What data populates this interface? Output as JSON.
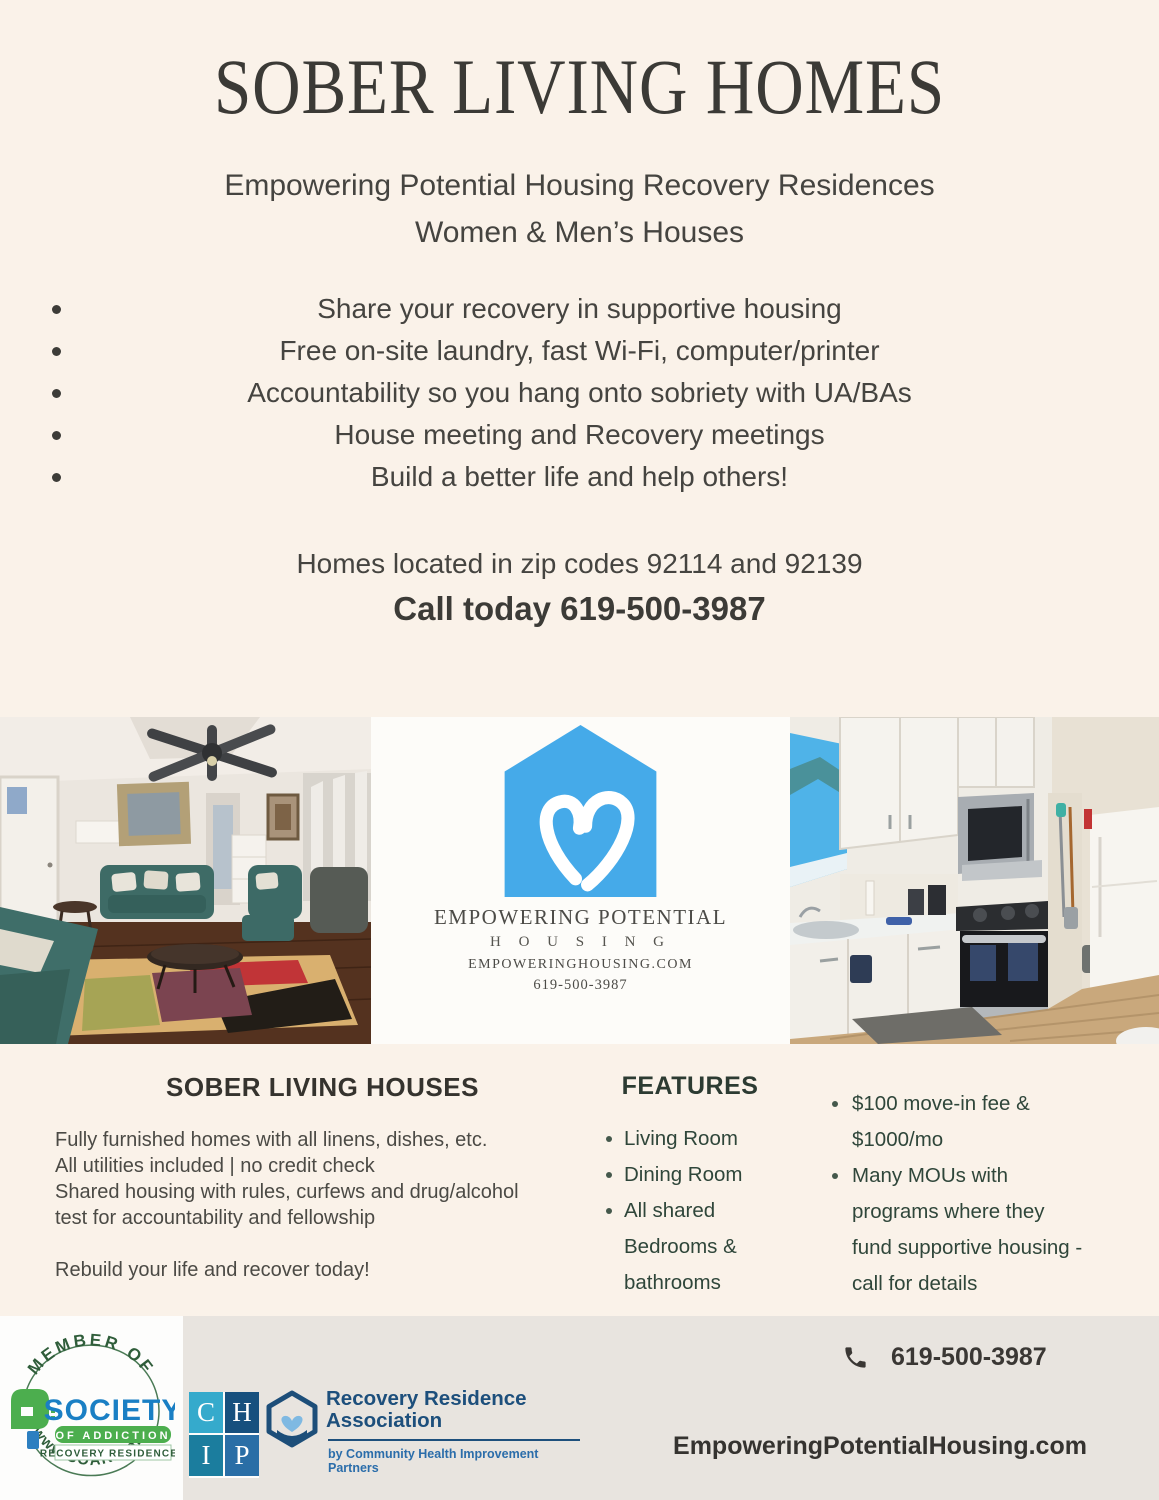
{
  "header": {
    "title": "SOBER LIVING HOMES",
    "subtitle_line1": "Empowering Potential Housing Recovery Residences",
    "subtitle_line2": "Women & Men’s Houses"
  },
  "bullets": [
    "Share your recovery in supportive housing",
    "Free on-site laundry, fast Wi-Fi, computer/printer",
    "Accountability so you hang onto sobriety with UA/BAs",
    "House meeting and Recovery meetings",
    "Build a better life and help others!"
  ],
  "location_line": "Homes located in zip codes 92114 and 92139",
  "call_line": "Call today 619-500-3987",
  "logo_panel": {
    "name_line1": "EMPOWERING POTENTIAL",
    "name_line2": "H O U S I N G",
    "website": "EMPOWERINGHOUSING.COM",
    "phone": "619-500-3987",
    "house_color": "#45aae9"
  },
  "info": {
    "left": {
      "heading": "SOBER LIVING HOUSES",
      "lines": [
        "Fully furnished homes with all linens, dishes, etc.",
        "All utilities included | no credit check",
        "Shared housing with rules, curfews and drug/alcohol",
        "test for accountability and fellowship"
      ],
      "cta": "Rebuild your life and recover today!"
    },
    "features": {
      "heading": "FEATURES",
      "items": [
        [
          "Living Room"
        ],
        [
          "Dining Room"
        ],
        [
          "All shared",
          "Bedrooms &",
          "bathrooms"
        ]
      ]
    },
    "pricing": {
      "items": [
        [
          "$100 move-in fee &",
          "$1000/mo"
        ],
        [
          "Many MOUs with",
          "programs where they",
          "fund supportive housing -",
          "call for details"
        ]
      ]
    }
  },
  "footer": {
    "phone": "619-500-3987",
    "website": "EmpoweringPotentialHousing.com",
    "soarr": {
      "arc_top": "MEMBER OF",
      "society": "SOCIETY",
      "of_addiction": "OF ADDICTION",
      "recovery_residences": "RECOVERY RESIDENCES",
      "arc_bottom": "www.SOARR.org"
    },
    "chip": {
      "letters": [
        "C",
        "H",
        "I",
        "P"
      ]
    },
    "rra": {
      "line1": "Recovery Residence",
      "line2": "Association",
      "byline": "by Community Health Improvement Partners"
    }
  }
}
